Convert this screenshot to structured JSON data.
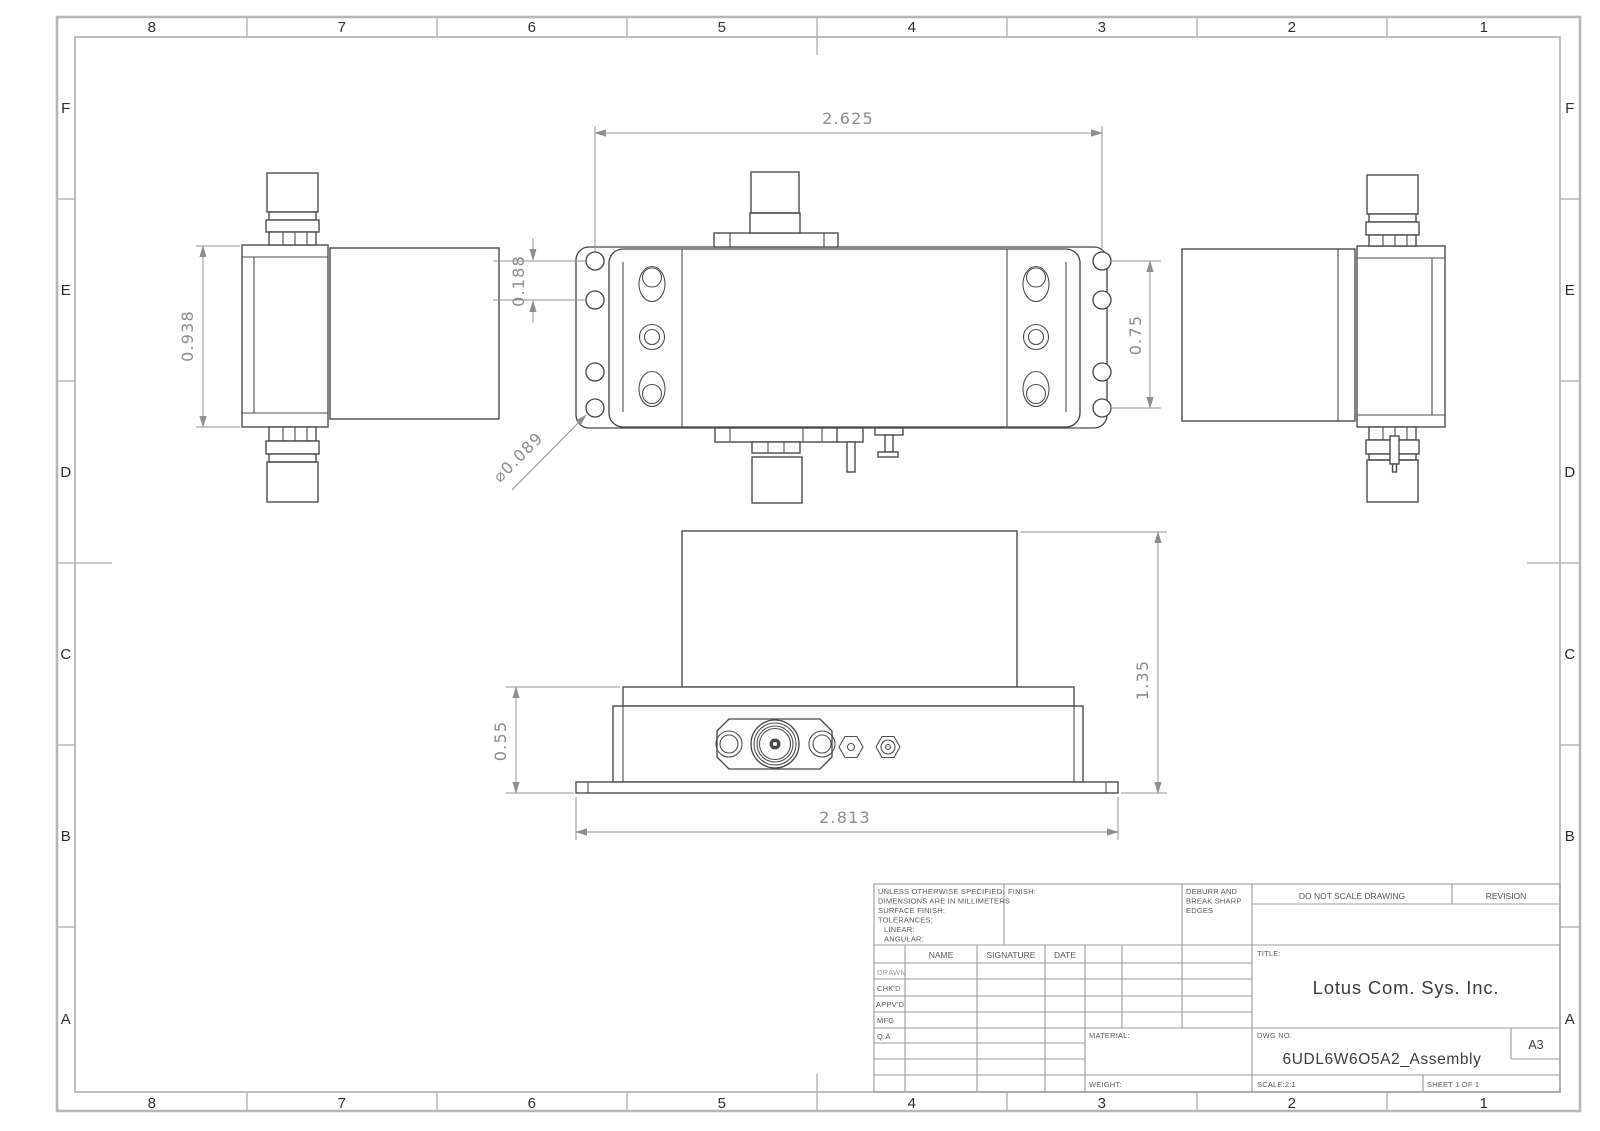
{
  "frame": {
    "cols": [
      "8",
      "7",
      "6",
      "5",
      "4",
      "3",
      "2",
      "1"
    ],
    "rows": [
      "F",
      "E",
      "D",
      "C",
      "B",
      "A"
    ]
  },
  "dims": {
    "top_width": "2.625",
    "hole_pitch": "0.188",
    "side_height": "0.938",
    "flange_height": "0.75",
    "hole_dia": "⌀0.089",
    "front_step": "0.55",
    "front_total": "1.35",
    "front_width": "2.813"
  },
  "title_block": {
    "spec_lines": [
      "UNLESS OTHERWISE SPECIFIED:",
      "DIMENSIONS ARE IN MILLIMETERS",
      "SURFACE FINISH:",
      "TOLERANCES:",
      "LINEAR:",
      "ANGULAR:"
    ],
    "finish_label": "FINISH:",
    "deburr_lines": [
      "DEBURR AND",
      "BREAK SHARP",
      "EDGES"
    ],
    "do_not_scale": "DO NOT SCALE DRAWING",
    "revision_label": "REVISION",
    "name_label": "NAME",
    "signature_label": "SIGNATURE",
    "date_label": "DATE",
    "row_labels": [
      "DRAWN",
      "CHK'D",
      "APPV'D",
      "MFG",
      "Q.A"
    ],
    "title_label": "TITLE:",
    "company": "Lotus Com. Sys. Inc.",
    "material_label": "MATERIAL:",
    "weight_label": "WEIGHT:",
    "dwg_label": "DWG NO.",
    "dwg_no": "6UDL6W6O5A2_Assembly",
    "paper_size": "A3",
    "scale_label": "SCALE:2:1",
    "sheet_label": "SHEET 1 OF 1"
  }
}
